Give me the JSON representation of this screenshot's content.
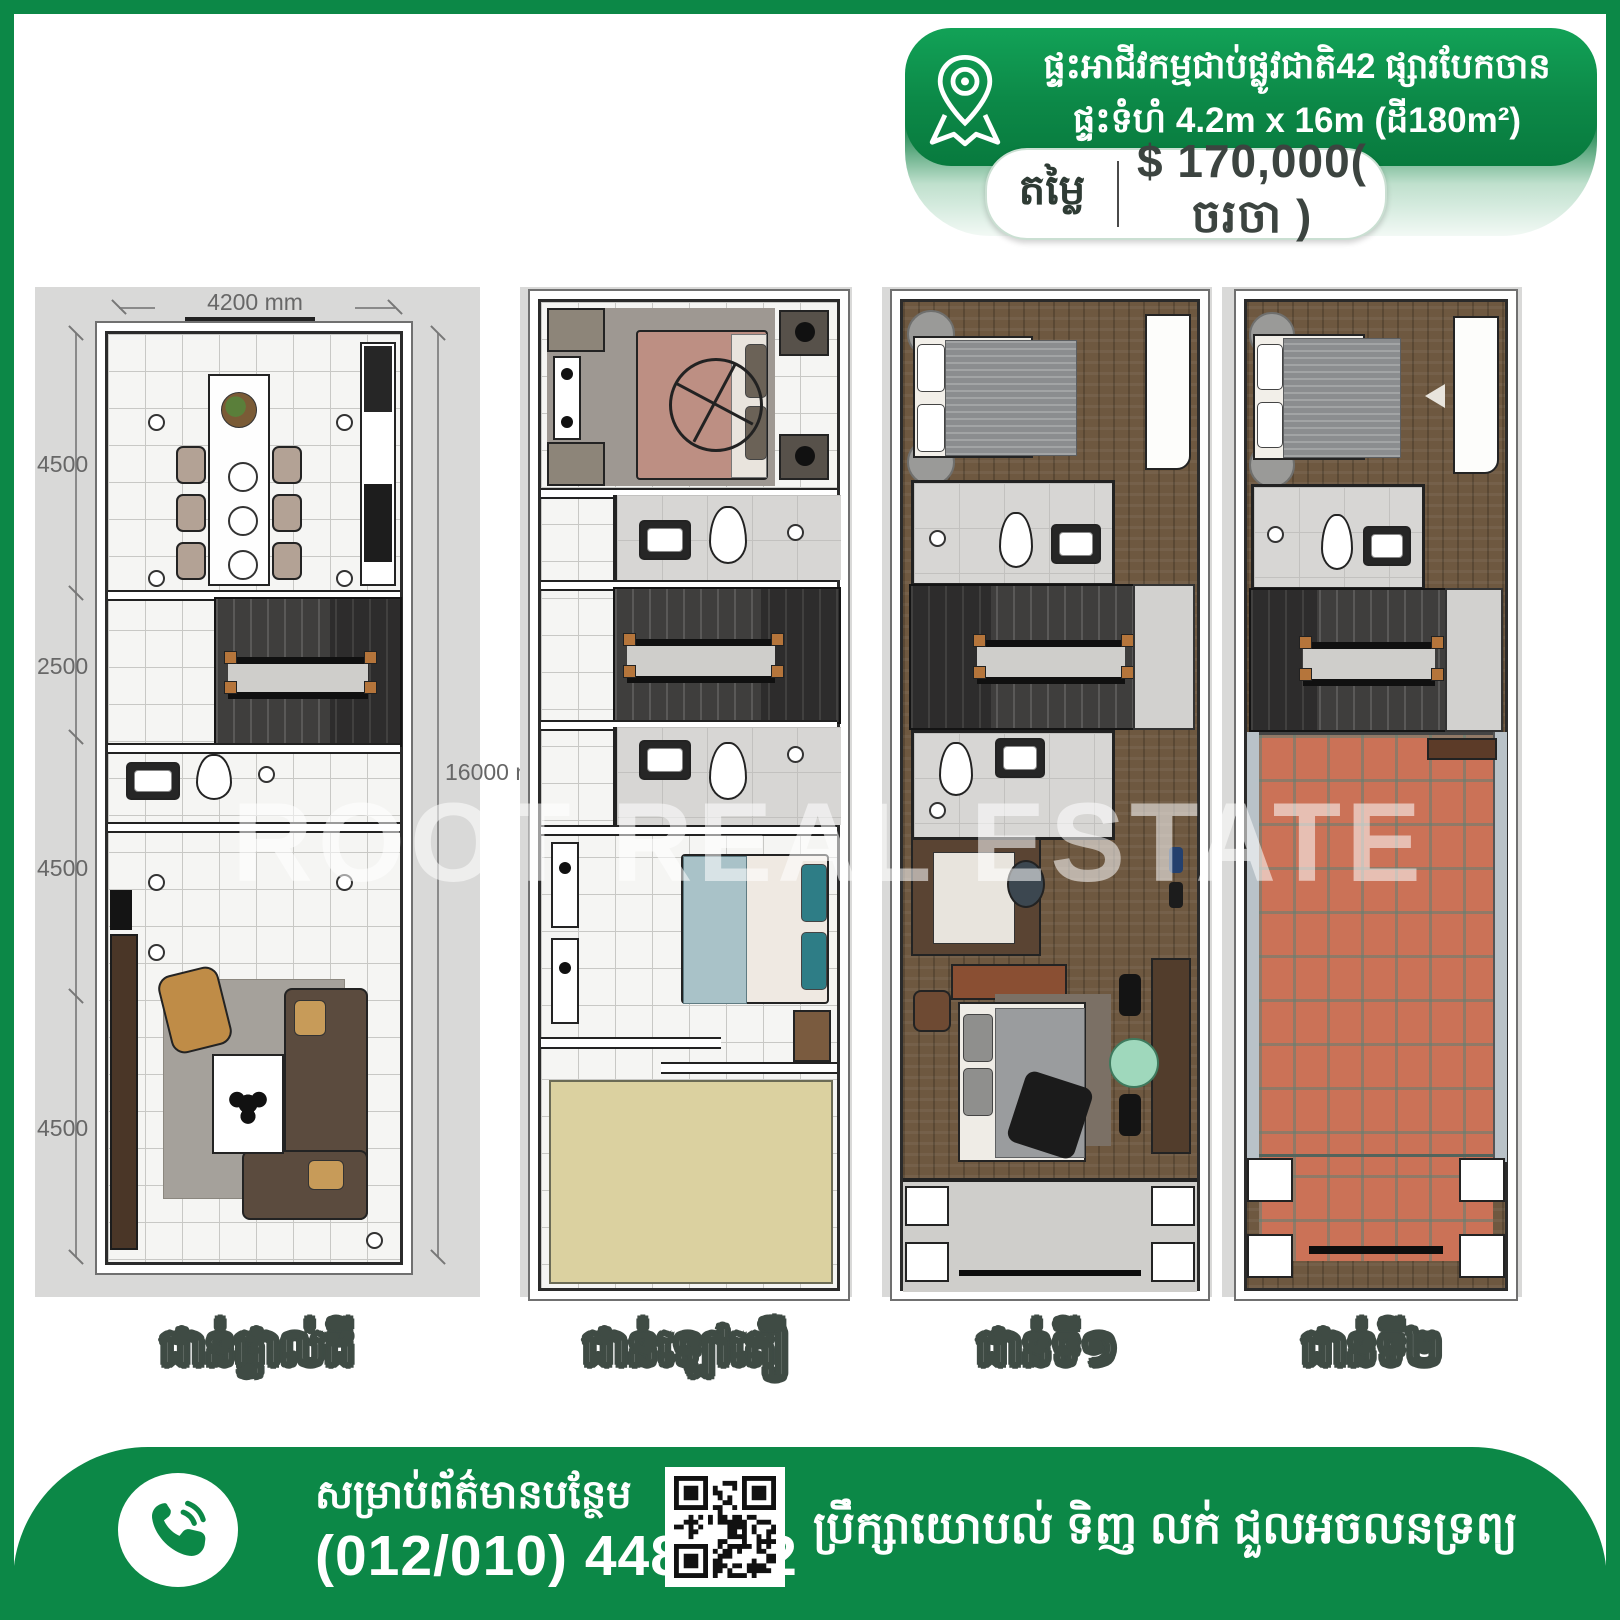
{
  "badge": {
    "line1": "ផ្ទះអាជីវកម្មជាប់ផ្លូវជាតិ42 ផ្សារបែកចាន",
    "line2": "ផ្ទះទំហំ 4.2m x 16m (ដី180m²)",
    "price_label": "តម្លៃ",
    "price_value": "$ 170,000( ចរចា )",
    "pin_icon": "map-pin-icon"
  },
  "plans": [
    {
      "label": "ជាន់ផ្ទាល់ដី",
      "dimensions": {
        "top": "4200 mm",
        "left": [
          "4500 mm",
          "2500 mm",
          "4500 mm",
          "4500 mm"
        ],
        "right": "16000 mm"
      }
    },
    {
      "label": "ជាន់ឡៅតឿ"
    },
    {
      "label": "ជាន់ទី១"
    },
    {
      "label": "ជាន់ទី២"
    }
  ],
  "watermark": "ROOT REAL ESTATE",
  "footer": {
    "info_label": "សម្រាប់ព័ត៌មានបន្ថែម",
    "phone_number": "(012/010) 448 202",
    "services_text": "ប្រឹក្សាយោបល់ ទិញ លក់ ជួលអចលនទ្រព្យ",
    "phone_icon": "phone-call-icon",
    "qr_icon": "qr-code"
  },
  "colors": {
    "brand_green": "#0c8847",
    "mint": "#e4f2e9",
    "panel_gray": "#d9d9d8",
    "terracotta": "#cb7257",
    "void_beige": "#dbd1a0",
    "label_outline": "#3f4b44"
  }
}
